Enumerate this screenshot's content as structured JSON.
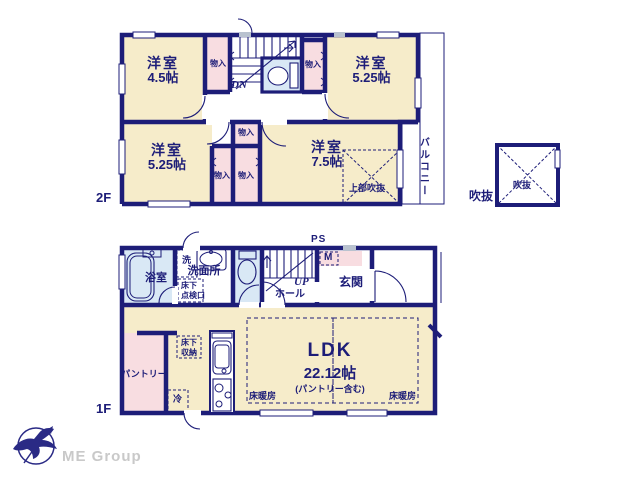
{
  "colors": {
    "wall_navy": "#1d1d78",
    "room_cream": "#f6ecca",
    "closet_pink": "#f8dde1",
    "wet_blue": "#d9e8f5",
    "gray_mark": "#b9c2cf",
    "brand_gray": "#c9c9c9"
  },
  "floor2": {
    "label": "2F",
    "room_nw_name": "洋室",
    "room_nw_size": "4.5帖",
    "room_ne_name": "洋室",
    "room_ne_size": "5.25帖",
    "room_sw_name": "洋室",
    "room_sw_size": "5.25帖",
    "room_se_name": "洋室",
    "room_se_size": "7.5帖",
    "closet_a": "物入",
    "closet_b": "物入",
    "closet_c": "物入",
    "closet_d": "物入",
    "closet_e": "物入",
    "stairs": "DN",
    "balcony": "バルコニー",
    "open_above": "上部吹抜",
    "void_outside": "吹抜",
    "void_inside": "吹抜"
  },
  "floor1": {
    "label": "1F",
    "bath": "浴室",
    "washer": "洗",
    "washroom": "洗面所",
    "hatch_line1": "床下",
    "hatch_line2": "点検口",
    "ps": "PS",
    "meter": "M",
    "stairs": "UP",
    "hall": "ホール",
    "entrance": "玄関",
    "ldk_name": "LDK",
    "ldk_size": "22.12帖",
    "ldk_note": "(パントリー含む)",
    "pantry": "パントリー",
    "storage_line1": "床下",
    "storage_line2": "収納",
    "fridge": "冷",
    "floor_heating_left": "床暖房",
    "floor_heating_right": "床暖房"
  },
  "footer": {
    "company": "ME Group"
  }
}
